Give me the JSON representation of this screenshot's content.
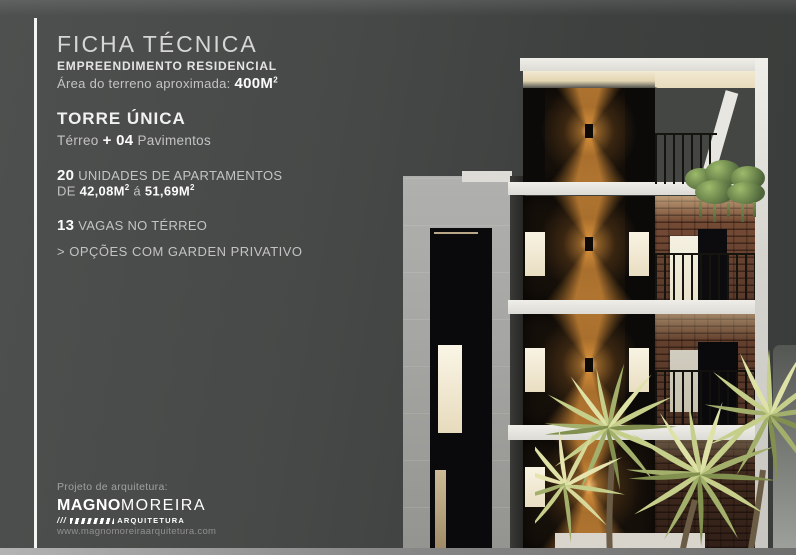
{
  "colors": {
    "panel_bg": "#474948",
    "accent_amber": "#c98435",
    "slab_white": "#e8e6e1",
    "brick": "#6f4734",
    "palm_green": "#c6cf8a"
  },
  "sheet": {
    "title": "FICHA TÉCNICA",
    "residential_heading": "EMPREENDIMENTO RESIDENCIAL",
    "terrain": {
      "label": "Área do terreno aproximada: ",
      "value": "400M",
      "sup": "2"
    },
    "tower": {
      "heading": "TORRE ÚNICA",
      "ground": "Térreo ",
      "plus": "+ ",
      "floors_num": "04",
      "floors_word": " Pavimentos"
    },
    "units": {
      "count": "20",
      "label": " UNIDADES DE APARTAMENTOS",
      "range_prefix": "DE ",
      "from": "42,08M",
      "from_sup": "2",
      "connector": " á ",
      "to": "51,69M",
      "to_sup": "2"
    },
    "parking": {
      "count": "13",
      "label": " VAGAS NO TÉRREO"
    },
    "option": "> OPÇÕES COM GARDEN PRIVATIVO"
  },
  "footer": {
    "credit_label": "Projeto de arquitetura:",
    "brand_primary": "MAGNO",
    "brand_secondary": "MOREIRA",
    "brand_slashes": "///",
    "brand_descriptor": "ARQUITETURA",
    "website": "www.magnomoreiraarquitetura.com"
  }
}
